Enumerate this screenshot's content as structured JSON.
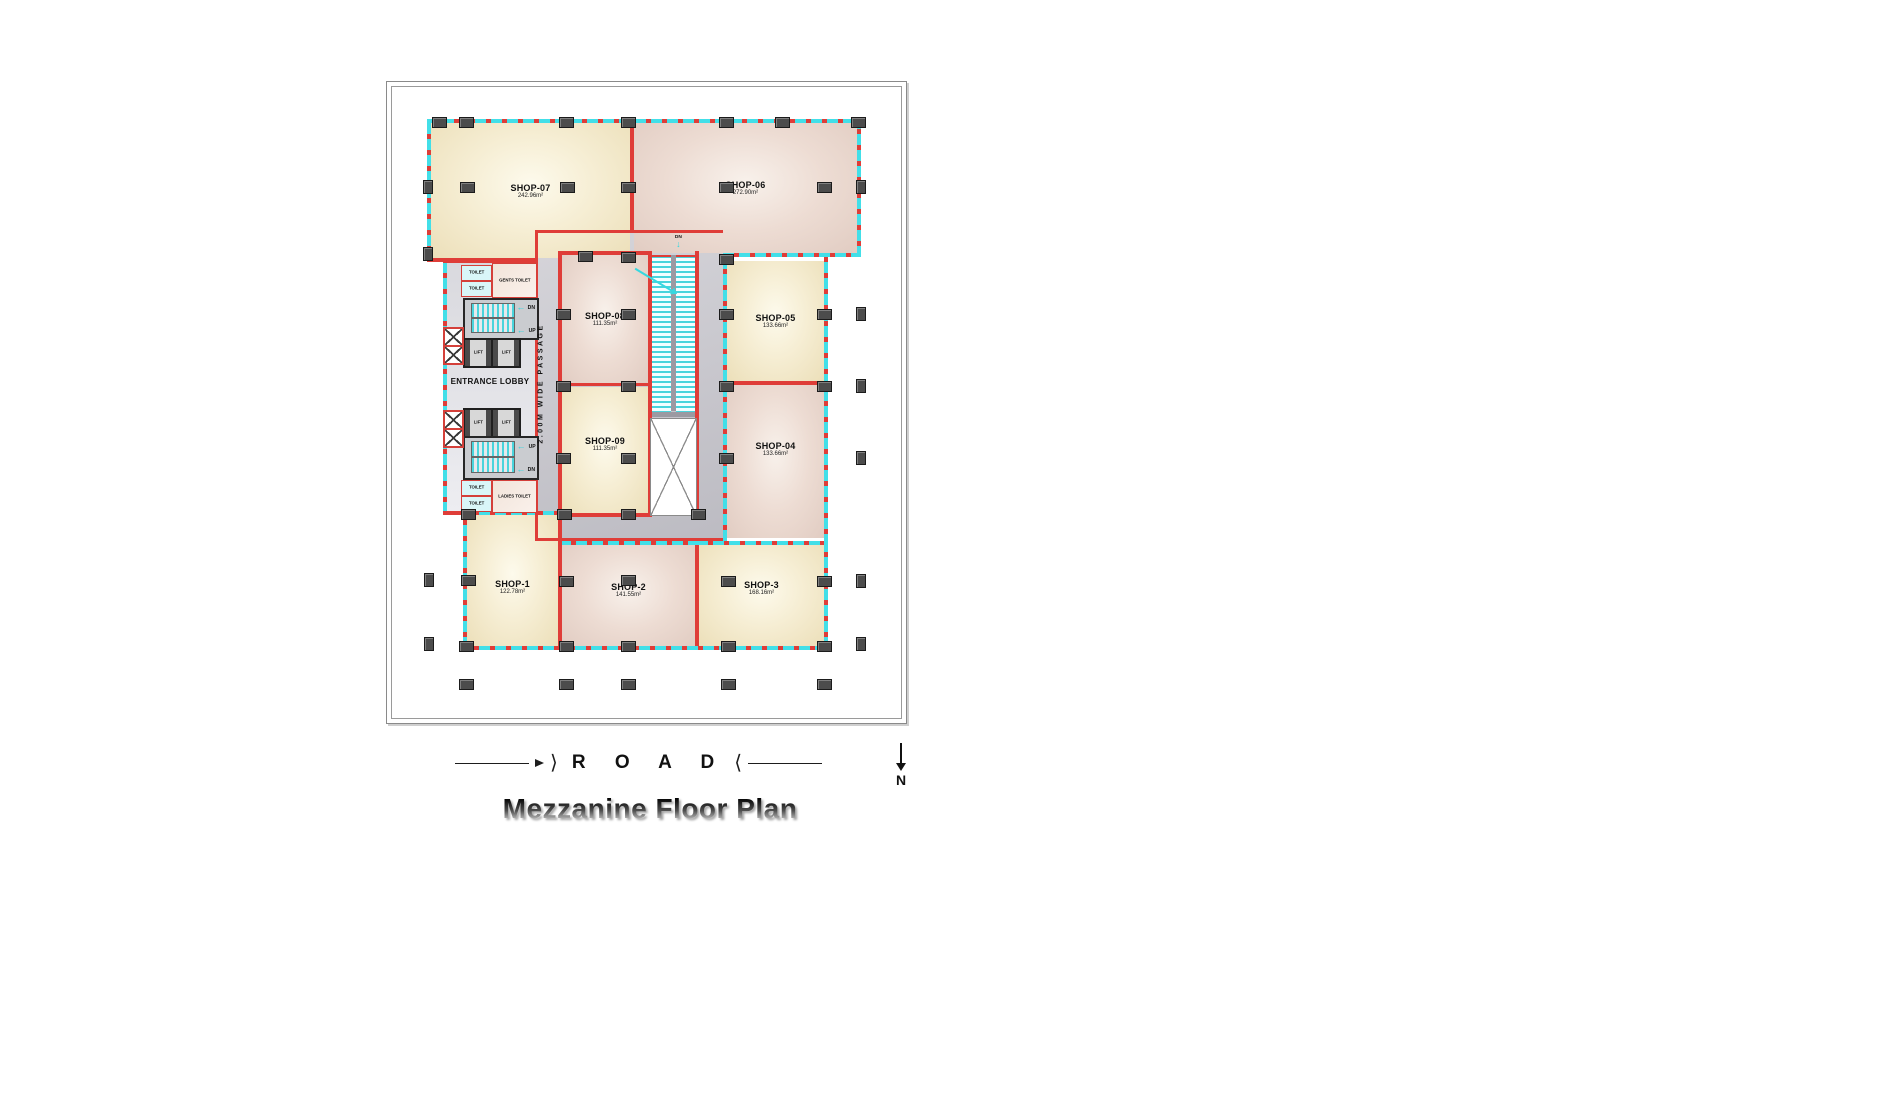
{
  "title": "Mezzanine Floor Plan",
  "road": {
    "label": "R O A D",
    "brackets": [
      "⟩",
      "⟨"
    ]
  },
  "north": {
    "label": "N"
  },
  "shops": {
    "shop1": {
      "name": "SHOP-1",
      "area": "122.78m²"
    },
    "shop2": {
      "name": "SHOP-2",
      "area": "141.55m²"
    },
    "shop3": {
      "name": "SHOP-3",
      "area": "168.16m²"
    },
    "shop4": {
      "name": "SHOP-04",
      "area": "133.66m²"
    },
    "shop5": {
      "name": "SHOP-05",
      "area": "133.66m²"
    },
    "shop6": {
      "name": "SHOP-06",
      "area": "272.90m²"
    },
    "shop7": {
      "name": "SHOP-07",
      "area": "242.96m²"
    },
    "shop8": {
      "name": "SHOP-08",
      "area": "111.35m²"
    },
    "shop9": {
      "name": "SHOP-09",
      "area": "111.35m²"
    }
  },
  "core": {
    "entrance_lobby": "ENTRANCE LOBBY",
    "passage": "2.00M WIDE PASSAGE",
    "gents_toilet": "GENTS TOILET",
    "ladies_toilet": "LADIES TOILET",
    "toilet": "TOILET",
    "lift": "LIFT",
    "up": "UP",
    "dn": "DN"
  },
  "colors": {
    "wall_red": "#df3d38",
    "glazing_cyan": "#42dfe8",
    "room_cream": "#f0e6c4",
    "room_pink": "#e6d2c8",
    "passage_gray": "#c6c5ca",
    "column_gray": "#4c4c4c"
  }
}
